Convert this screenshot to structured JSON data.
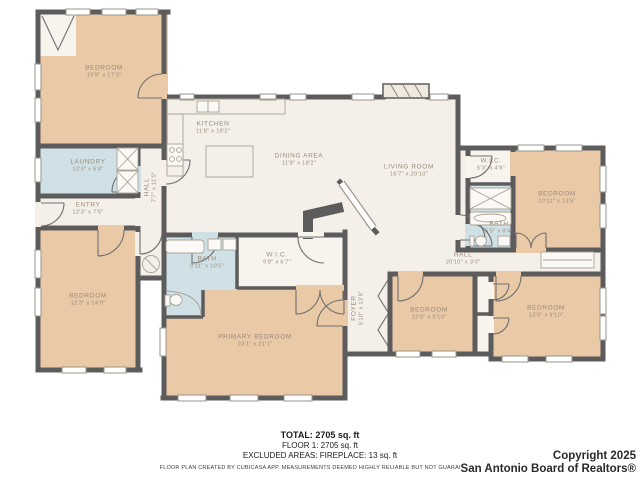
{
  "rooms": {
    "bedroom_tl": {
      "name": "BEDROOM",
      "dims": "15'9\" x 17'3\""
    },
    "laundry": {
      "name": "LAUNDRY",
      "dims": "12'3\" x 6'4\""
    },
    "entry": {
      "name": "ENTRY",
      "dims": "12'3\" x 7'5\""
    },
    "hall_left": {
      "name": "HALL",
      "dims": "7'7\" x 11'0\""
    },
    "bedroom_left": {
      "name": "BEDROOM",
      "dims": "12'3\" x 14'9\""
    },
    "kitchen": {
      "name": "KITCHEN",
      "dims": "11'8\" x 18'2\""
    },
    "dining": {
      "name": "DINING AREA",
      "dims": "11'9\" x 18'2\""
    },
    "living": {
      "name": "LIVING ROOM",
      "dims": "16'7\" x 20'10\""
    },
    "wic_right": {
      "name": "W.I.C.",
      "dims": "5'3\" x 4'9\""
    },
    "bath_right": {
      "name": "BATH",
      "dims": "5'5\" x 8'4\""
    },
    "bedroom_right": {
      "name": "BEDROOM",
      "dims": "10'11\" x 13'5\""
    },
    "hall": {
      "name": "HALL",
      "dims": "20'10\" x 3'0\""
    },
    "foyer": {
      "name": "FOYER",
      "dims": "5'10\" x 13'9\""
    },
    "bath_primary": {
      "name": "BATH",
      "dims": "9'11\" x 10'5\""
    },
    "wic_primary": {
      "name": "W.I.C.",
      "dims": "9'8\" x 6'7\""
    },
    "primary": {
      "name": "PRIMARY BEDROOM",
      "dims": "23'1\" x 21'1\""
    },
    "bedroom_mid": {
      "name": "BEDROOM",
      "dims": "12'0\" x 9'10\""
    },
    "bedroom_br": {
      "name": "BEDROOM",
      "dims": "13'9\" x 9'10\""
    }
  },
  "footer": {
    "total": "TOTAL: 2705 sq. ft",
    "floor": "FLOOR 1: 2705 sq. ft",
    "excluded": "EXCLUDED AREAS: FIREPLACE: 13 sq. ft",
    "disclaimer": "FLOOR PLAN CREATED BY CUBICASA APP. MEASUREMENTS DEEMED HIGHLY RELIABLE BUT NOT GUARANTEED."
  },
  "copyright": {
    "line1": "Copyright 2025",
    "line2": "San Antonio Board of Realtors®"
  },
  "colors": {
    "wall": "#5c5c5c",
    "room_tan": "#eac9a7",
    "room_cream": "#f4f0e9",
    "room_blue": "#cfe1e6",
    "label_text": "#9a8a7a"
  }
}
